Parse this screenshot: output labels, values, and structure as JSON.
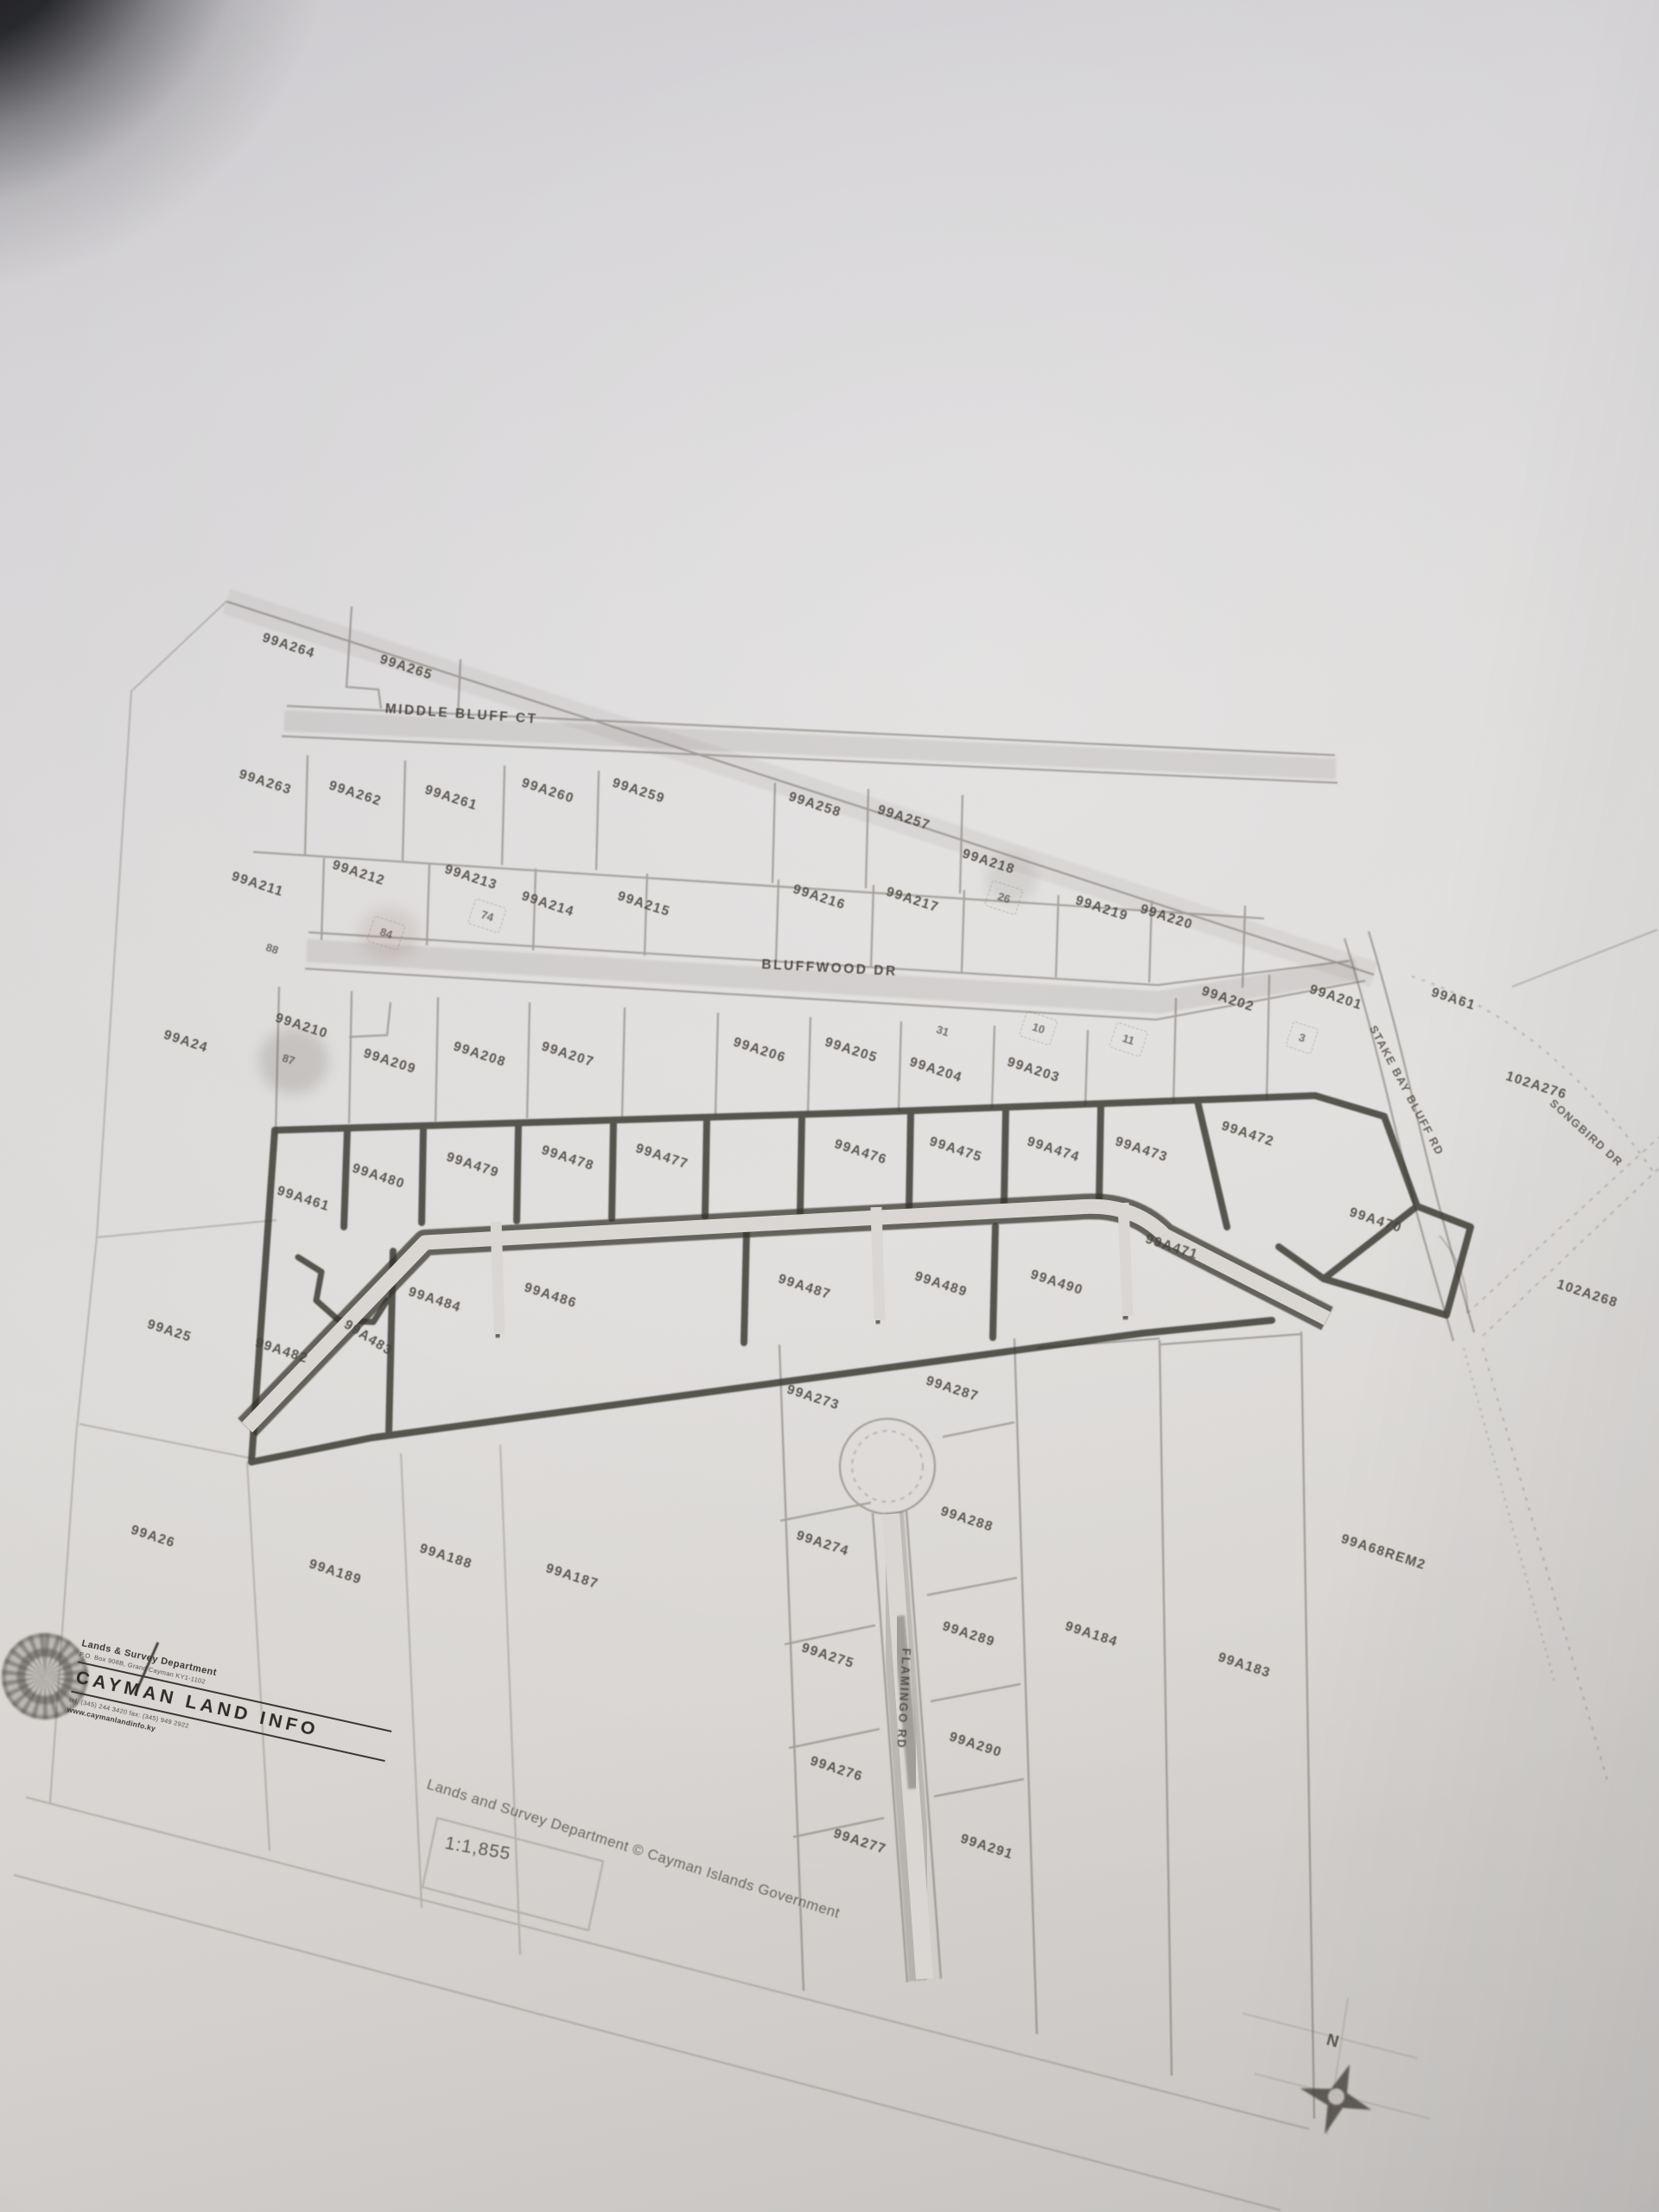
{
  "map": {
    "parcel_labels": [
      {
        "t": "99A264",
        "x": 17.4,
        "y": 29.2,
        "r": 18
      },
      {
        "t": "99A265",
        "x": 24.5,
        "y": 30.2,
        "r": 18
      },
      {
        "t": "99A263",
        "x": 16.0,
        "y": 35.4,
        "r": 18
      },
      {
        "t": "99A262",
        "x": 21.4,
        "y": 35.9,
        "r": 18
      },
      {
        "t": "99A261",
        "x": 27.2,
        "y": 36.1,
        "r": 18
      },
      {
        "t": "99A260",
        "x": 33.0,
        "y": 35.8,
        "r": 18
      },
      {
        "t": "99A259",
        "x": 38.5,
        "y": 35.8,
        "r": 18
      },
      {
        "t": "99A258",
        "x": 49.1,
        "y": 36.4,
        "r": 18
      },
      {
        "t": "99A257",
        "x": 54.5,
        "y": 37.0,
        "r": 18
      },
      {
        "t": "99A211",
        "x": 15.5,
        "y": 40.0,
        "r": 18
      },
      {
        "t": "99A212",
        "x": 21.6,
        "y": 39.5,
        "r": 18
      },
      {
        "t": "99A213",
        "x": 28.4,
        "y": 39.7,
        "r": 18
      },
      {
        "t": "99A214",
        "x": 33.0,
        "y": 40.9,
        "r": 18
      },
      {
        "t": "99A215",
        "x": 38.8,
        "y": 40.9,
        "r": 18
      },
      {
        "t": "99A216",
        "x": 49.4,
        "y": 40.6,
        "r": 18
      },
      {
        "t": "99A217",
        "x": 55.0,
        "y": 40.7,
        "r": 18
      },
      {
        "t": "99A218",
        "x": 59.6,
        "y": 39.0,
        "r": 18
      },
      {
        "t": "99A219",
        "x": 66.4,
        "y": 41.1,
        "r": 18
      },
      {
        "t": "99A220",
        "x": 70.3,
        "y": 41.5,
        "r": 18
      },
      {
        "t": "99A24",
        "x": 11.2,
        "y": 47.1,
        "r": 18
      },
      {
        "t": "99A210",
        "x": 18.2,
        "y": 46.4,
        "r": 18
      },
      {
        "t": "99A209",
        "x": 23.5,
        "y": 48.0,
        "r": 18
      },
      {
        "t": "99A208",
        "x": 28.9,
        "y": 47.7,
        "r": 18
      },
      {
        "t": "99A207",
        "x": 34.2,
        "y": 47.7,
        "r": 18
      },
      {
        "t": "99A206",
        "x": 45.8,
        "y": 47.5,
        "r": 18
      },
      {
        "t": "99A205",
        "x": 51.3,
        "y": 47.5,
        "r": 18
      },
      {
        "t": "99A204",
        "x": 56.4,
        "y": 48.4,
        "r": 18
      },
      {
        "t": "99A203",
        "x": 62.3,
        "y": 48.4,
        "r": 18
      },
      {
        "t": "99A202",
        "x": 74.0,
        "y": 45.2,
        "r": 18
      },
      {
        "t": "99A201",
        "x": 80.5,
        "y": 45.1,
        "r": 18
      },
      {
        "t": "99A61",
        "x": 87.6,
        "y": 45.2,
        "r": 18
      },
      {
        "t": "102A276",
        "x": 92.6,
        "y": 49.1,
        "r": 18
      },
      {
        "t": "99A461",
        "x": 18.3,
        "y": 54.2,
        "r": 18
      },
      {
        "t": "99A480",
        "x": 22.8,
        "y": 53.2,
        "r": 18
      },
      {
        "t": "99A479",
        "x": 28.5,
        "y": 52.7,
        "r": 18
      },
      {
        "t": "99A478",
        "x": 34.2,
        "y": 52.4,
        "r": 18
      },
      {
        "t": "99A477",
        "x": 39.9,
        "y": 52.3,
        "r": 18
      },
      {
        "t": "99A476",
        "x": 51.9,
        "y": 52.1,
        "r": 18
      },
      {
        "t": "99A475",
        "x": 57.6,
        "y": 52.0,
        "r": 18
      },
      {
        "t": "99A474",
        "x": 63.5,
        "y": 52.0,
        "r": 18
      },
      {
        "t": "99A473",
        "x": 68.8,
        "y": 52.0,
        "r": 18
      },
      {
        "t": "99A472",
        "x": 75.2,
        "y": 51.3,
        "r": 18
      },
      {
        "t": "99A471",
        "x": 70.6,
        "y": 56.4,
        "r": 18
      },
      {
        "t": "99A470",
        "x": 82.9,
        "y": 55.2,
        "r": 18
      },
      {
        "t": "102A268",
        "x": 95.7,
        "y": 58.5,
        "r": 18
      },
      {
        "t": "99A25",
        "x": 10.2,
        "y": 60.2,
        "r": 18
      },
      {
        "t": "99A482",
        "x": 17.0,
        "y": 61.1,
        "r": 18
      },
      {
        "t": "99A483",
        "x": 22.2,
        "y": 60.5,
        "r": 32
      },
      {
        "t": "99A484",
        "x": 26.2,
        "y": 58.8,
        "r": 18
      },
      {
        "t": "99A486",
        "x": 33.2,
        "y": 58.6,
        "r": 18
      },
      {
        "t": "99A487",
        "x": 48.5,
        "y": 58.2,
        "r": 18
      },
      {
        "t": "99A489",
        "x": 56.7,
        "y": 58.1,
        "r": 18
      },
      {
        "t": "99A490",
        "x": 63.7,
        "y": 58.0,
        "r": 18
      },
      {
        "t": "99A273",
        "x": 49.0,
        "y": 63.2,
        "r": 18
      },
      {
        "t": "99A287",
        "x": 57.4,
        "y": 62.8,
        "r": 18
      },
      {
        "t": "99A288",
        "x": 58.3,
        "y": 68.7,
        "r": 18
      },
      {
        "t": "99A274",
        "x": 49.6,
        "y": 69.8,
        "r": 18
      },
      {
        "t": "99A289",
        "x": 58.4,
        "y": 73.9,
        "r": 18
      },
      {
        "t": "99A275",
        "x": 49.9,
        "y": 74.9,
        "r": 18
      },
      {
        "t": "99A184",
        "x": 65.8,
        "y": 73.9,
        "r": 18
      },
      {
        "t": "99A183",
        "x": 75.0,
        "y": 75.3,
        "r": 18
      },
      {
        "t": "99A68REM2",
        "x": 83.4,
        "y": 70.2,
        "r": 18
      },
      {
        "t": "99A290",
        "x": 58.8,
        "y": 78.9,
        "r": 18
      },
      {
        "t": "99A276",
        "x": 50.4,
        "y": 80.0,
        "r": 18
      },
      {
        "t": "99A277",
        "x": 51.8,
        "y": 83.3,
        "r": 18
      },
      {
        "t": "99A291",
        "x": 59.5,
        "y": 83.5,
        "r": 18
      },
      {
        "t": "99A26",
        "x": 9.2,
        "y": 69.5,
        "r": 18
      },
      {
        "t": "99A189",
        "x": 20.2,
        "y": 71.1,
        "r": 18
      },
      {
        "t": "99A188",
        "x": 26.9,
        "y": 70.4,
        "r": 18
      },
      {
        "t": "99A187",
        "x": 34.5,
        "y": 71.3,
        "r": 18
      }
    ],
    "small_numbers": [
      {
        "t": "88",
        "x": 16.4,
        "y": 42.9,
        "r": 18,
        "box": false
      },
      {
        "t": "84",
        "x": 23.3,
        "y": 42.2,
        "r": 18,
        "box": true
      },
      {
        "t": "74",
        "x": 29.4,
        "y": 41.4,
        "r": 18,
        "box": true
      },
      {
        "t": "26",
        "x": 60.5,
        "y": 40.6,
        "r": 18,
        "box": true
      },
      {
        "t": "87",
        "x": 17.4,
        "y": 47.9,
        "r": 18,
        "box": false
      },
      {
        "t": "31",
        "x": 56.8,
        "y": 46.6,
        "r": 18,
        "box": false
      },
      {
        "t": "10",
        "x": 62.6,
        "y": 46.5,
        "r": 18,
        "box": true
      },
      {
        "t": "11",
        "x": 68.0,
        "y": 47.0,
        "r": 18,
        "box": true
      },
      {
        "t": "3",
        "x": 78.5,
        "y": 46.9,
        "r": 18,
        "box": true
      }
    ],
    "road_labels": [
      {
        "t": "MIDDLE BLUFF CT",
        "x": 27.8,
        "y": 32.3,
        "r": 4,
        "cls": "road"
      },
      {
        "t": "BLUFFWOOD DR",
        "x": 50.0,
        "y": 43.8,
        "r": 3,
        "cls": "road"
      },
      {
        "t": "FLAMINGO RD",
        "x": 54.5,
        "y": 76.8,
        "r": 93,
        "cls": "roadv"
      },
      {
        "t": "STAKE BAY BLUFF RD",
        "x": 84.8,
        "y": 49.3,
        "r": 62,
        "cls": "roaddiag"
      },
      {
        "t": "SONGBIRD DR",
        "x": 95.6,
        "y": 51.2,
        "r": 42,
        "cls": "roaddiag"
      }
    ],
    "scale_label": "1:1,855",
    "copyright": "Lands and Survey Department © Cayman Islands Government",
    "north_indicator": "N"
  },
  "title_block": {
    "department": "Lands & Survey Department",
    "address": "P.O. Box 908B, Grand Cayman KY1-1102",
    "brand": "CAYMAN LAND INFO",
    "contact": "tel: (345) 244 3420   fax: (345) 949 2922",
    "website": "www.caymanlandinfo.ky"
  }
}
